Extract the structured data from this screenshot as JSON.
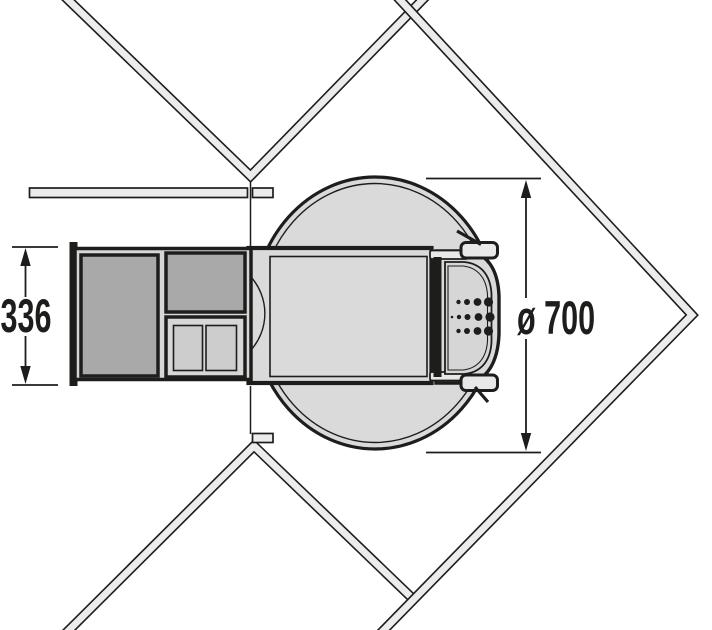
{
  "drawing": {
    "name": "corner-cabinet-carousel-plan-view",
    "dimensions": {
      "cabinet_depth": {
        "label": "336"
      },
      "carousel_diameter": {
        "label": "ø 700"
      }
    },
    "colors": {
      "line": "#1d1d1b",
      "wall_fill": "#ececec",
      "unit_fill": "#dadada",
      "dark_bin_fill": "#a9a9a9",
      "compartment_fill": "#cdcdcd",
      "background": "#ffffff"
    }
  }
}
